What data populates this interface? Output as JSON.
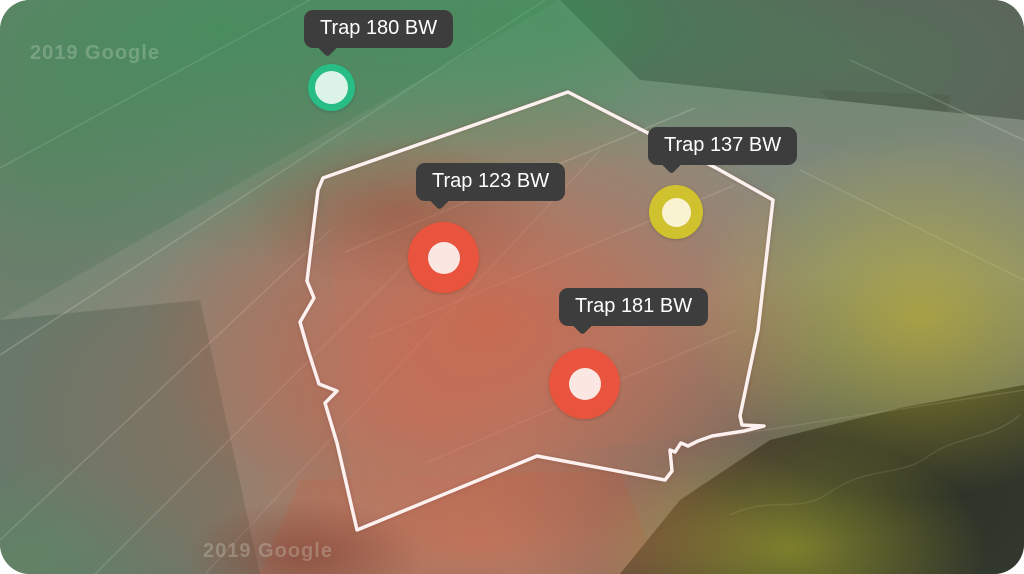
{
  "map": {
    "attribution_text": "2019 Google",
    "boundary_color": "#fcf1ef",
    "heatmap_colors": {
      "high_pressure": "#e0563c",
      "medium_pressure": "#cfc02d",
      "low_pressure": "#2f9a56"
    }
  },
  "tooltip": {
    "background": "#3d3d3d",
    "text_color": "#ffffff"
  },
  "traps": [
    {
      "label": "Trap 180 BW",
      "marker_color": "#29bd86",
      "core_color": "#dcf4e8"
    },
    {
      "label": "Trap 123 BW",
      "marker_color": "#e8543e",
      "core_color": "#fbe7e2"
    },
    {
      "label": "Trap 137 BW",
      "marker_color": "#d0c12e",
      "core_color": "#f9f3d2"
    },
    {
      "label": "Trap 181 BW",
      "marker_color": "#e8543e",
      "core_color": "#fbe7e2"
    }
  ]
}
